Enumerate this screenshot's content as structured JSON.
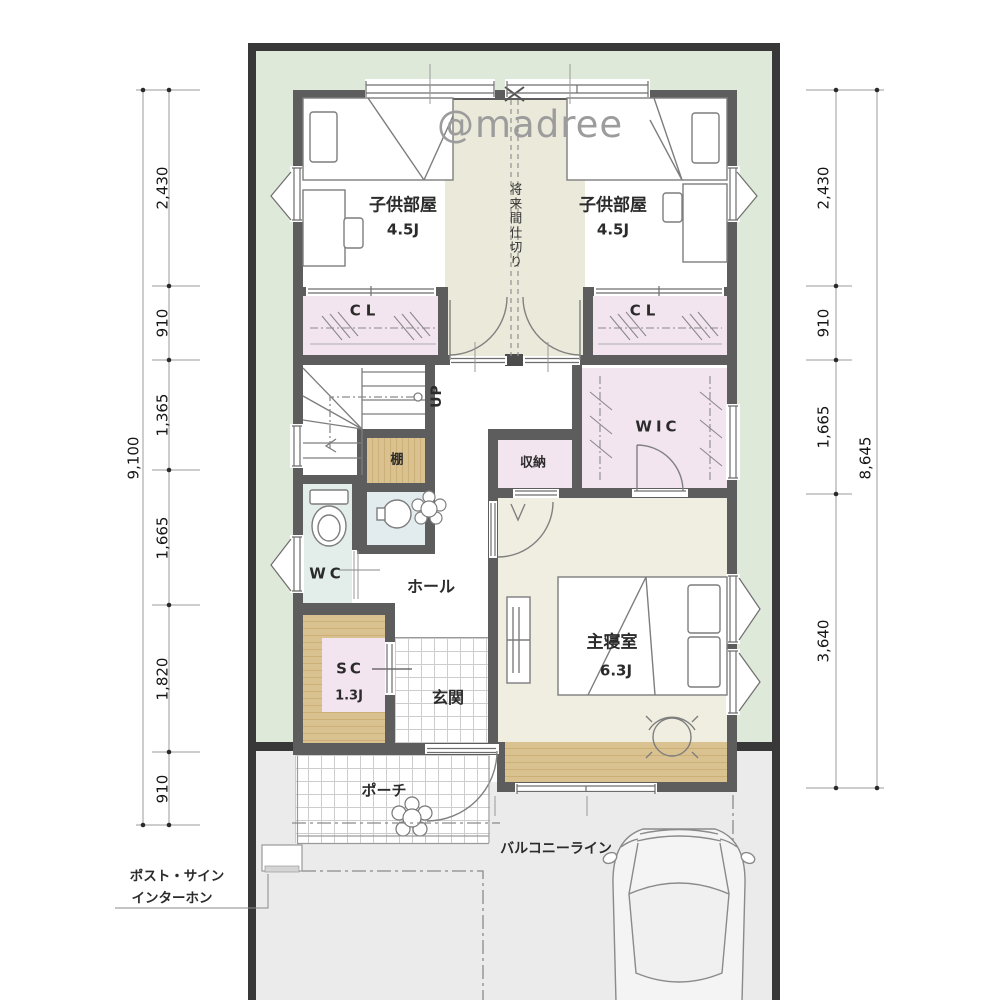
{
  "watermark": "@madree",
  "labels": {
    "child_room": "子供部屋",
    "child_size": "4.5J",
    "future_partition": "将来間仕切り",
    "closet": "CL",
    "up": "UP",
    "shelf": "棚",
    "storage": "収納",
    "wic": "WIC",
    "wc": "WC",
    "hall": "ホール",
    "sc": "SC",
    "sc_size": "1.3J",
    "entrance": "玄関",
    "master_bedroom": "主寝室",
    "master_size": "6.3J",
    "porch": "ポーチ",
    "balcony_line": "バルコニーライン",
    "post_sign": "ポスト・サイン",
    "intercom": "インターホン"
  },
  "dimensions": {
    "left": {
      "segments": [
        "2,430",
        "910",
        "1,365",
        "1,665",
        "1,820",
        "910"
      ],
      "total": "9,100"
    },
    "right": {
      "segments": [
        "2,430",
        "910",
        "1,665",
        "3,640"
      ],
      "total": "8,645"
    }
  },
  "colors": {
    "site_green": "#dfe9d9",
    "site_border": "#383838",
    "wall_gray": "#5d5d5d",
    "closet_pink": "#f3e5f0",
    "floor_cream": "#f0eee1",
    "corridor_cream": "#ebe9da",
    "wet_area_green": "#e3ede9",
    "wash_nook_blue": "#e2ecee",
    "wood_tan": "#d9c190",
    "driveway_gray": "#ebebeb"
  }
}
